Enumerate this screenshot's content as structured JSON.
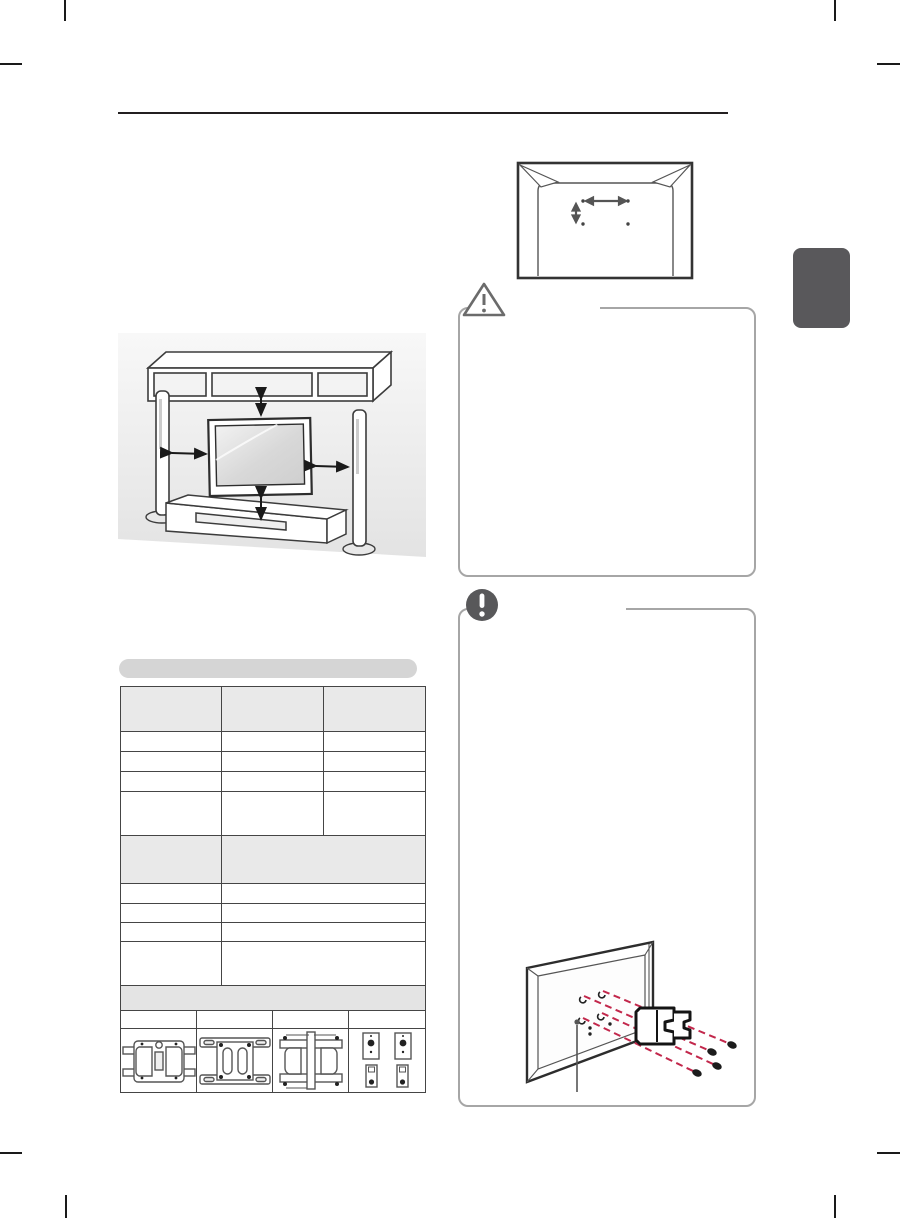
{
  "page": {
    "kind": "tv-owners-manual-page",
    "background": "#ffffff",
    "visible_text": "",
    "note": "text layer not rendered; only line-art graphics visible"
  },
  "colors": {
    "line_dark": "#231f20",
    "table_border": "#454545",
    "table_header_fill": "#e9e9e9",
    "pill_fill": "#d5d5d5",
    "callout_border": "#a6a6a6",
    "icon_gray": "#6b6b6b",
    "note_icon_fill": "#58585a",
    "side_tab_fill": "#59585b",
    "screw_line_red": "#c2274b",
    "wall_fill": "#ececec"
  },
  "header": {
    "rule_present": true,
    "title_text": ""
  },
  "side_tab": {
    "label": ""
  },
  "vesa_diagram": {
    "holes": 4,
    "dimension_arrows": [
      "horizontal",
      "vertical"
    ],
    "label_a": "",
    "label_b": ""
  },
  "clearance_illustration": {
    "elements": [
      "wall-shelf",
      "left-speaker",
      "right-speaker",
      "tv",
      "low-cabinet"
    ],
    "clearance_arrows": 4
  },
  "caution_box": {
    "caption": "",
    "icon": "warning-triangle-icon",
    "body_text": ""
  },
  "note_box": {
    "caption": "",
    "icon": "exclamation-circle-icon",
    "body_text": ""
  },
  "spec_pill": {
    "label": ""
  },
  "spec_table": {
    "header": [
      "",
      "",
      ""
    ],
    "s1_rows": [
      [
        "",
        "",
        ""
      ],
      [
        "",
        "",
        ""
      ],
      [
        "",
        "",
        ""
      ],
      [
        "",
        "",
        ""
      ]
    ],
    "header2": [
      "",
      ""
    ],
    "s2_rows": [
      [
        "",
        ""
      ],
      [
        "",
        ""
      ],
      [
        "",
        ""
      ],
      [
        "",
        ""
      ]
    ]
  },
  "bracket_table": {
    "header": "",
    "labels": [
      "",
      "",
      "",
      ""
    ],
    "images": [
      "wall-bracket-type-1",
      "wall-bracket-type-2",
      "wall-bracket-type-3",
      "wall-bracket-type-4"
    ]
  },
  "mounting_diagram": {
    "screws": 4,
    "dashed_line_color": "#c2274b",
    "parts": [
      "tv-rear",
      "wall-mount-bracket",
      "screws",
      "leader-line"
    ]
  }
}
